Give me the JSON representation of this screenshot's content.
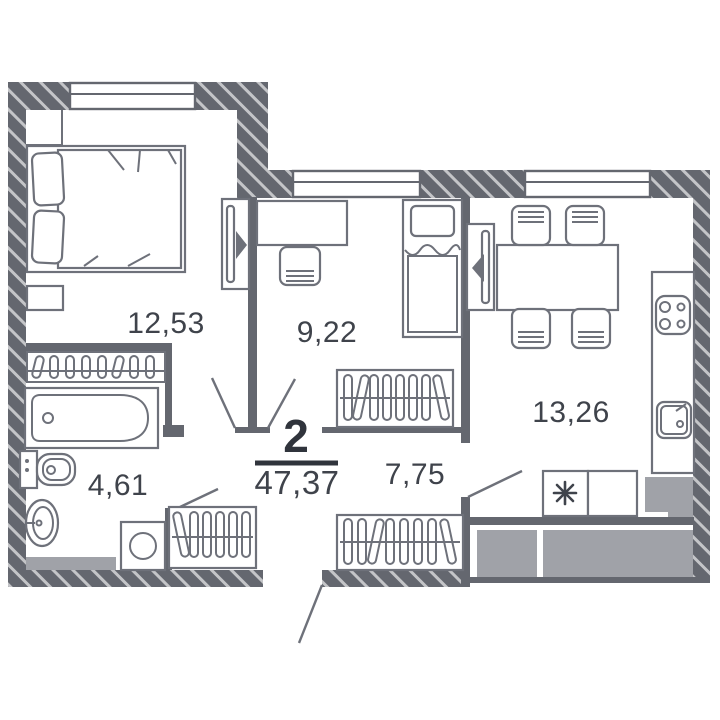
{
  "plan": {
    "rooms_count_label": "2",
    "total_area": "47,37",
    "rooms": {
      "bedroom": {
        "area": "12,53"
      },
      "bedroom2": {
        "area": "9,22"
      },
      "kitchen": {
        "area": "13,26"
      },
      "bathroom": {
        "area": "4,61"
      },
      "hallway": {
        "area": "7,75"
      }
    },
    "colors": {
      "wall": "#64676F",
      "furniture": "#6E717A",
      "label_text": "#3F434B",
      "emphasis_text": "#30343C",
      "shaft_fill": "#A0A2A8",
      "background": "#FFFFFF"
    }
  }
}
